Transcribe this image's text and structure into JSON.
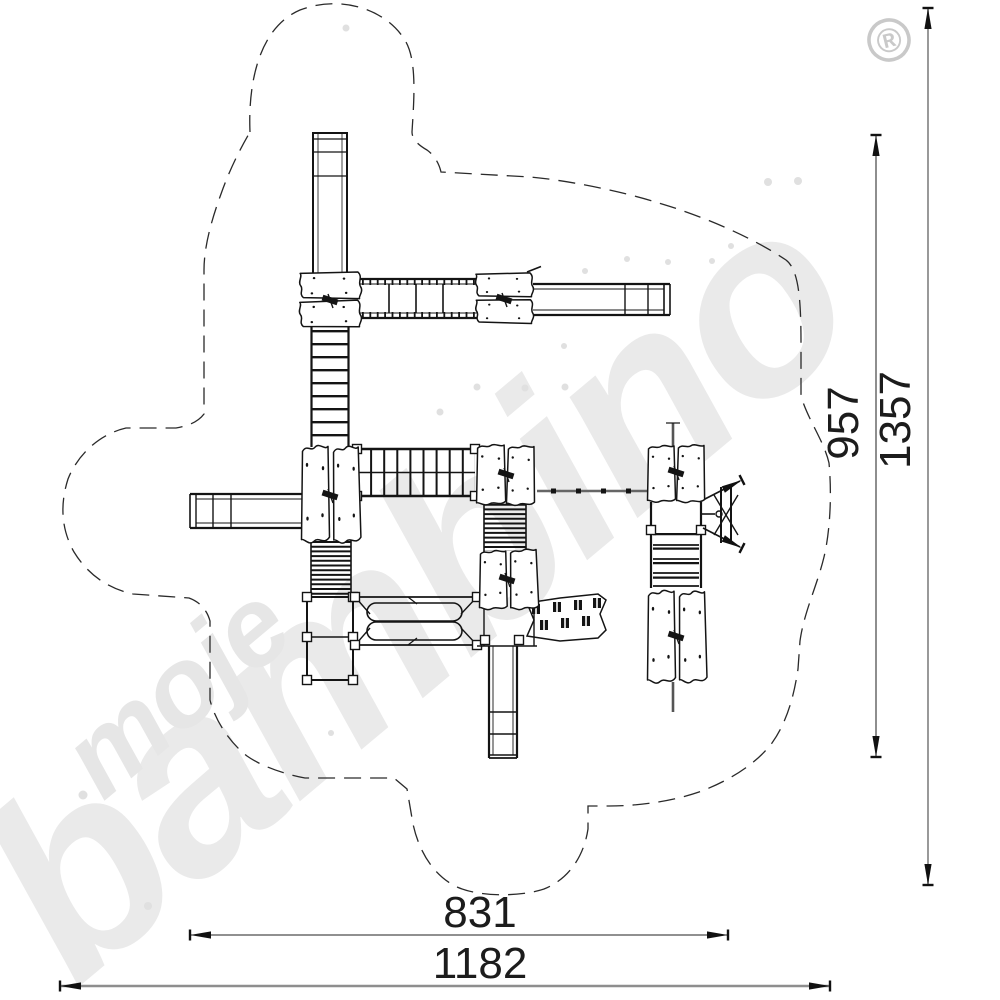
{
  "drawing": {
    "type": "playground-equipment plan view, technical dimension drawing",
    "dimensions": {
      "inner_height": "957",
      "outer_height": "1357",
      "inner_width": "831",
      "outer_width": "1182"
    },
    "watermark": {
      "word_small": "moje",
      "word_large": "bambino",
      "registered_mark": "®",
      "color": "#e9e9e9"
    },
    "colors": {
      "line": "#141414",
      "dashed_outline": "#2a2a2a",
      "gray_dim_line": "#8e8e8e"
    },
    "components": [
      "safety-zone-dashed-outline",
      "tower-slide",
      "rope-bridge",
      "platforms",
      "right-slide",
      "left-slide",
      "bottom-slide",
      "climbing-ladder",
      "climbing-net",
      "ribbed-ramp",
      "ground-frame",
      "double-balance-beam",
      "grip-plank",
      "balance-beam",
      "side-climber"
    ]
  }
}
